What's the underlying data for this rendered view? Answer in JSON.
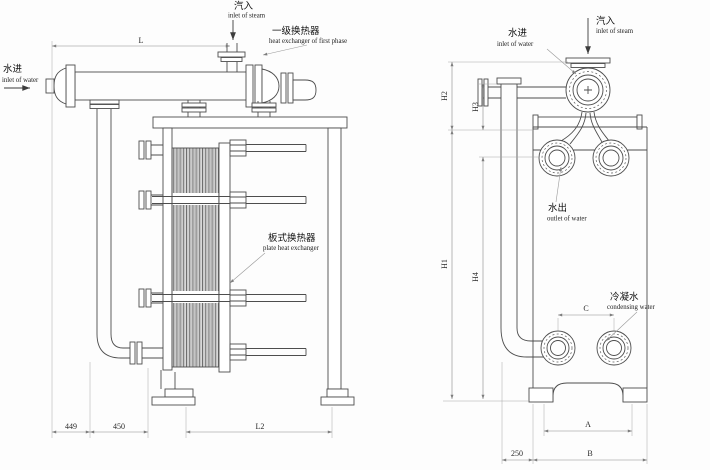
{
  "drawing": {
    "left_view": {
      "steam_inlet_zh": "汽入",
      "steam_inlet_en": "inlet of steam",
      "water_inlet_zh": "水进",
      "water_inlet_en": "inlet of water",
      "first_phase_zh": "一级换热器",
      "first_phase_en": "heat exchanger of first phase",
      "plate_hx_zh": "板式换热器",
      "plate_hx_en": "plate heat exchanger",
      "dim_L": "L",
      "dim_L2": "L2",
      "dim_449": "449",
      "dim_450": "450"
    },
    "right_view": {
      "steam_inlet_zh": "汽入",
      "steam_inlet_en": "inlet of steam",
      "water_inlet_zh": "水进",
      "water_inlet_en": "inlet of water",
      "water_outlet_zh": "水出",
      "water_outlet_en": "outlet of water",
      "condensing_zh": "冷凝水",
      "condensing_en": "condensing water",
      "dim_H1": "H1",
      "dim_H2": "H2",
      "dim_H3": "H3",
      "dim_H4": "H4",
      "dim_A": "A",
      "dim_B": "B",
      "dim_C": "C",
      "dim_250": "250"
    }
  }
}
